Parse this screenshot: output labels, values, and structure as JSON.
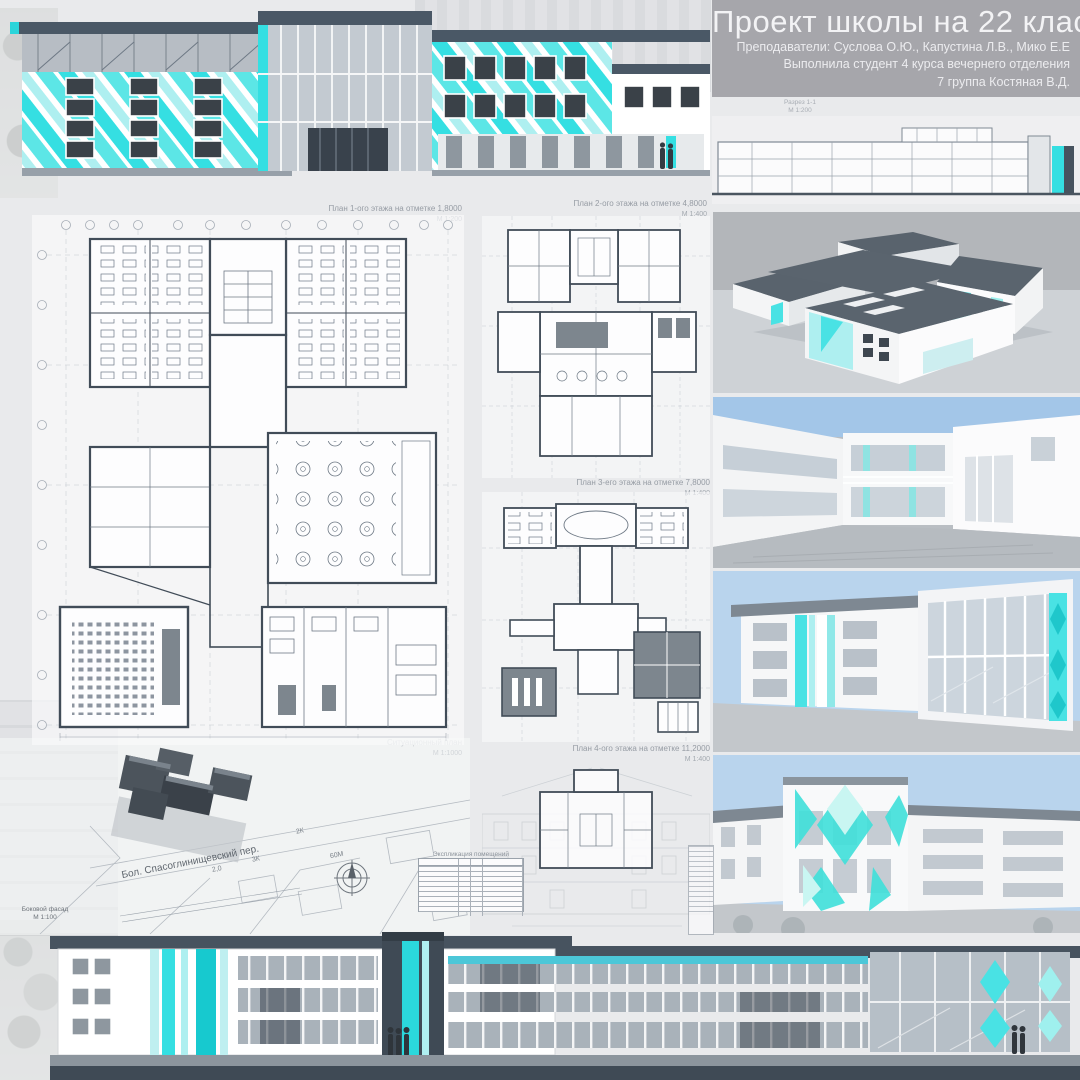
{
  "header": {
    "title": "Проект школы на 22 класса",
    "teachers": "Преподаватели: Суслова О.Ю., Капустина Л.В., Мико Е.Е",
    "student_line1": "Выполнила студент 4 курса вечернего отделения",
    "student_line2": "7 группа Костяная В.Д."
  },
  "section": {
    "label": "Разрез 1-1",
    "scale": "М 1:200"
  },
  "plans": {
    "plan1": {
      "label": "План 1-ого этажа на отметке 1,8000",
      "scale": "М 1:200"
    },
    "plan2": {
      "label": "План 2-ого этажа на отметке 4,8000",
      "scale": "М 1:400"
    },
    "plan3": {
      "label": "План 3-его этажа на отметке 7,8000",
      "scale": "М 1:400"
    },
    "plan4": {
      "label": "План 4-ого этажа на отметке 11,2000",
      "scale": "М 1:400"
    }
  },
  "site": {
    "label": "Ситуационный план",
    "scale": "М 1:1000",
    "street": "Бол. Спасоглинищевский пер.",
    "annotations": [
      "2К",
      "3К",
      "60М",
      "2,0"
    ]
  },
  "side_facade": {
    "label": "Боковой фасад",
    "scale": "М 1:100"
  },
  "rooms_table": {
    "title": "Экспликация помещений"
  },
  "colors": {
    "teal": "#35dfe2",
    "teal_light": "#aeeff0",
    "teal_dark": "#17c9cf",
    "slate": "#47535f",
    "window_dark": "#3a4148",
    "sky": "#a9c9e7",
    "header_gray": "#a6a6ab"
  }
}
